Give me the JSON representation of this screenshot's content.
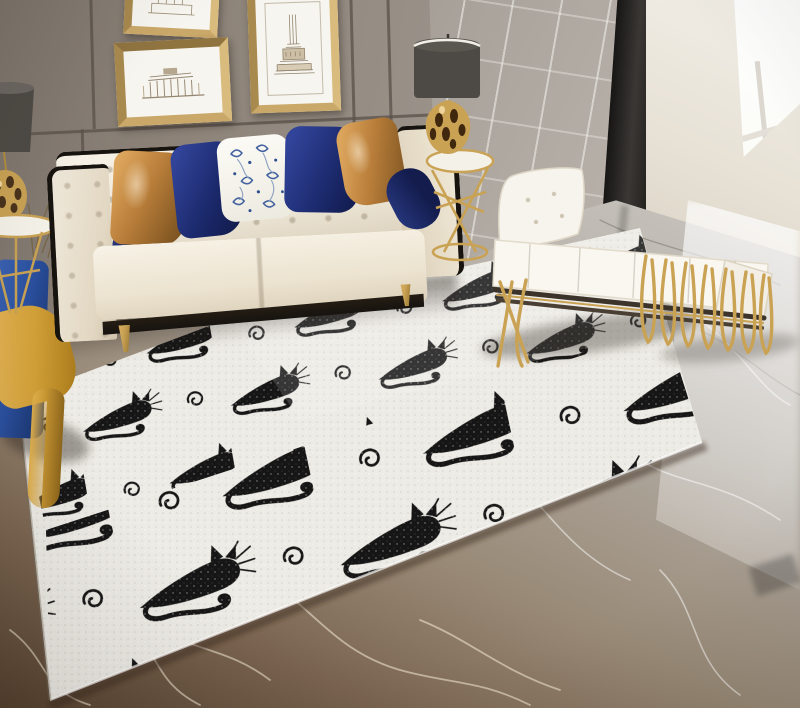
{
  "scene": {
    "type": "product-photo",
    "subject": "black-cat silhouette area rug in a styled living room",
    "objects": [
      "cat-pattern-rug",
      "cream-tufted-sofa",
      "throw-pillows",
      "navy-bolster-pillows",
      "caramel-leather-pillows",
      "floral-pillow",
      "white-gold-daybed-bench",
      "drum-shade-table-lamp-left",
      "drum-shade-table-lamp-right",
      "gold-wire-side-table",
      "round-gold-side-table",
      "blue-velvet-armchair",
      "mustard-throw-blanket",
      "framed-architecture-sketch-top",
      "framed-brandenburg-gate-sketch",
      "framed-victory-column-sketch",
      "taupe-panel-wall",
      "gray-tile-wall",
      "dark-pillar",
      "bright-window",
      "marble-floor"
    ],
    "rug_pattern": {
      "motifs": [
        "reclining-black-cat-facing-right",
        "spiral-swirl"
      ],
      "layout": "offset rows, cats alternating with small swirls",
      "background": "off-white flecked weave"
    }
  },
  "palette": {
    "wall-left": "#8d8379",
    "wall-right": "#a39c94",
    "wall-beige": "#e6e0d4",
    "trim-black": "#17130f",
    "sofa-cream": "#efe8d9",
    "sofa-shadow": "#d7cbb6",
    "navy": "#1c2a6e",
    "navy-dark": "#131c4d",
    "caramel": "#b97e3a",
    "caramel-light": "#dca55c",
    "floral-blue": "#44639f",
    "chair-blue": "#2a4f9e",
    "throw-yellow": "#d2a037",
    "gold": "#c9a254",
    "gold-dark": "#8a6a28",
    "lamp-shade": "#4d4944",
    "rug-bg": "#edebe5",
    "cat-black": "#161616",
    "floor-gray": "#b2aca4",
    "floor-brown": "#7a6450",
    "floor-dark": "#54402e"
  }
}
